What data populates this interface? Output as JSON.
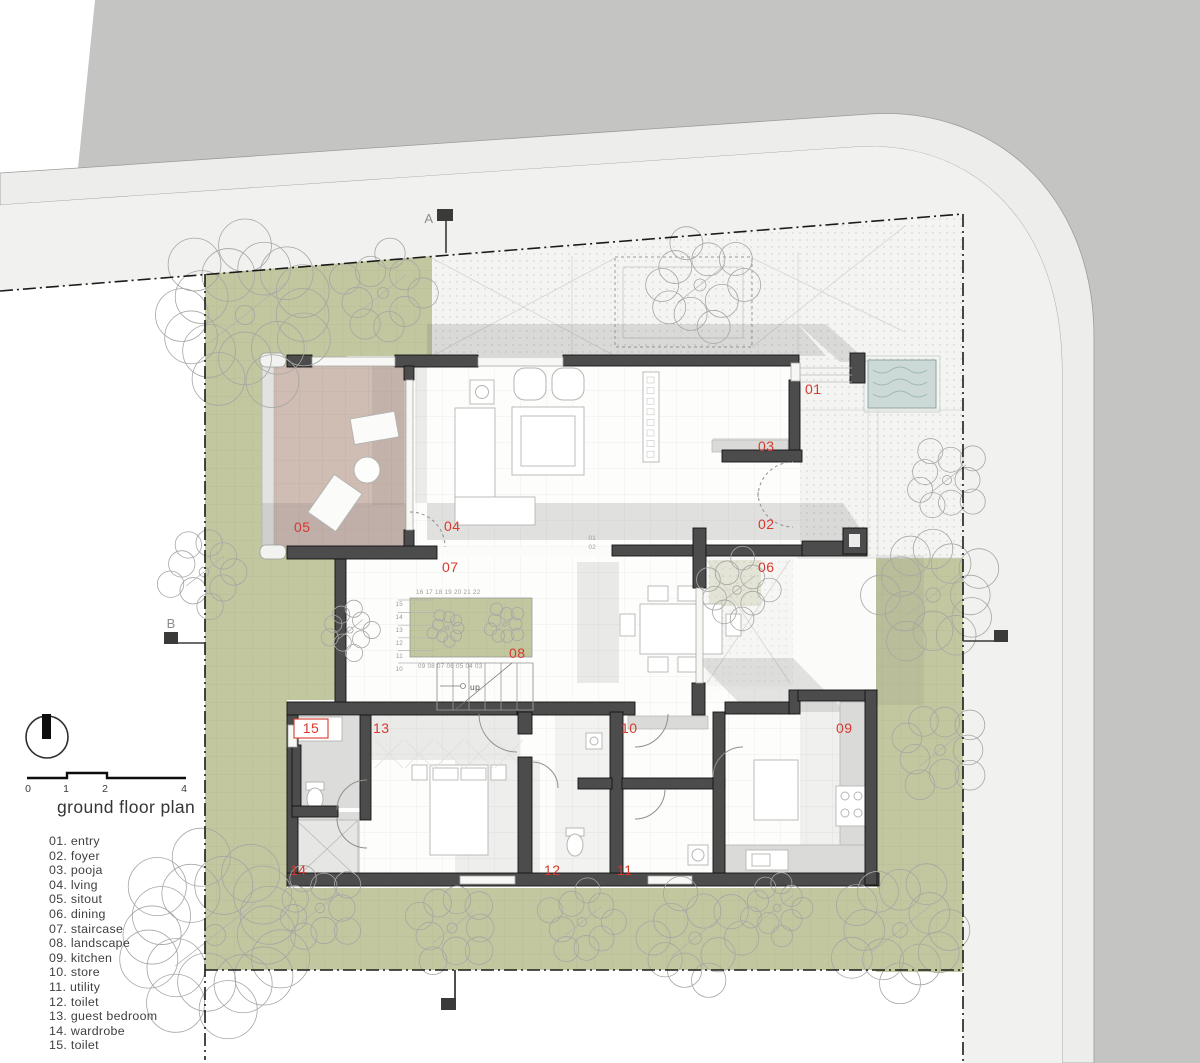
{
  "title": "ground floor plan",
  "legend": {
    "title": "ground floor plan",
    "items": [
      {
        "num": "01",
        "label": "entry"
      },
      {
        "num": "02",
        "label": "foyer"
      },
      {
        "num": "03",
        "label": "pooja"
      },
      {
        "num": "04",
        "label": "lving"
      },
      {
        "num": "05",
        "label": "sitout"
      },
      {
        "num": "06",
        "label": "dining"
      },
      {
        "num": "07",
        "label": "staircase"
      },
      {
        "num": "08",
        "label": "landscape"
      },
      {
        "num": "09",
        "label": "kitchen"
      },
      {
        "num": "10",
        "label": "store"
      },
      {
        "num": "11",
        "label": "utility"
      },
      {
        "num": "12",
        "label": "toilet"
      },
      {
        "num": "13",
        "label": "guest bedroom"
      },
      {
        "num": "14",
        "label": "wardrobe"
      },
      {
        "num": "15",
        "label": "toilet"
      }
    ]
  },
  "scalebar": {
    "ticks": [
      "0",
      "1",
      "2",
      "4"
    ]
  },
  "sections": {
    "a": "A",
    "b": "B"
  },
  "plan": {
    "up_label": "up",
    "step_labels": [
      "01",
      "02"
    ],
    "stairs": {
      "top": "16  17  18  19  20  21  22",
      "bottom": "09  08  07  06  05  04  03",
      "left": [
        "15",
        "14",
        "13",
        "12",
        "11",
        "10"
      ]
    }
  },
  "colors": {
    "label_red": "#d8392f",
    "landscape_green": "#c3c79f",
    "wall_dark": "#4c4c4c",
    "water_blue": "#ccd9d6",
    "road_gray": "#c4c4c3",
    "sitout_pink": "#cfbcb3"
  }
}
